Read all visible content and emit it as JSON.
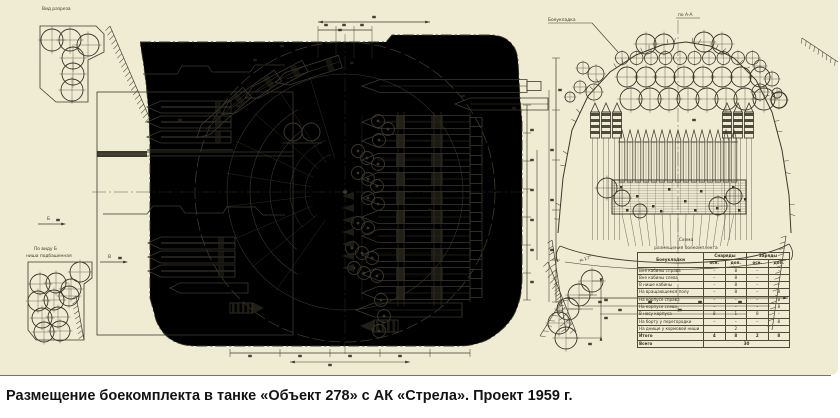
{
  "page": {
    "caption": "Размещение боекомплекта в танке «Объект 278» с АК «Стрела». Проект 1959 г."
  },
  "colors": {
    "paper": "#efecd3",
    "paper_edge": "#d9d5b8",
    "ink": "#3b382c",
    "dark": "#262418",
    "caption_text": "#131313",
    "white": "#ffffff"
  },
  "left_view": {
    "label_top_left": "Вид разреза",
    "label_bottom_left_1": "По виду Б",
    "label_bottom_left_2": "ниша подбашенная",
    "arrow_upper_label": "Б",
    "arrow_lower_label": "В"
  },
  "middle": {
    "angle_label": "м.17°"
  },
  "right_view": {
    "label_top": "по А-А",
    "leader_label": "Боеукладка",
    "scheme_label_1": "Схема",
    "scheme_label_2": "размещения боекомплекта"
  },
  "table": {
    "corner": "Боеукладки",
    "groups": [
      "Снаряды",
      "Заряды"
    ],
    "subheaders": [
      "осн.",
      "доп.",
      "осн.",
      "доп."
    ],
    "rows": [
      {
        "label": "Вне кабины справа",
        "values": [
          "–",
          "8",
          "–",
          "–"
        ]
      },
      {
        "label": "Вне кабины слева",
        "values": [
          "–",
          "8",
          "–",
          "–"
        ]
      },
      {
        "label": "В нише кабины",
        "values": [
          "–",
          "8",
          "–",
          "–"
        ]
      },
      {
        "label": "На вращающемся полу",
        "values": [
          "–",
          "8",
          "–",
          "8"
        ]
      },
      {
        "label": "На корпусе справа",
        "values": [
          "–",
          "–",
          "–",
          "8"
        ]
      },
      {
        "label": "На корпусе слева",
        "values": [
          "–",
          "–",
          "–",
          "8"
        ]
      },
      {
        "label": "В носу корпуса",
        "values": [
          "8",
          "1",
          "8",
          "–"
        ]
      },
      {
        "label": "На борту у перегородки",
        "values": [
          "–",
          "–",
          "–",
          "8"
        ]
      },
      {
        "label": "На днище у кормовой ниши",
        "values": [
          "",
          "2",
          "",
          ""
        ]
      }
    ],
    "totals_row": {
      "label": "Итого",
      "values": [
        "4",
        "8",
        "2",
        "8"
      ]
    },
    "grand_total": {
      "label": "Всего",
      "value": "30"
    }
  }
}
